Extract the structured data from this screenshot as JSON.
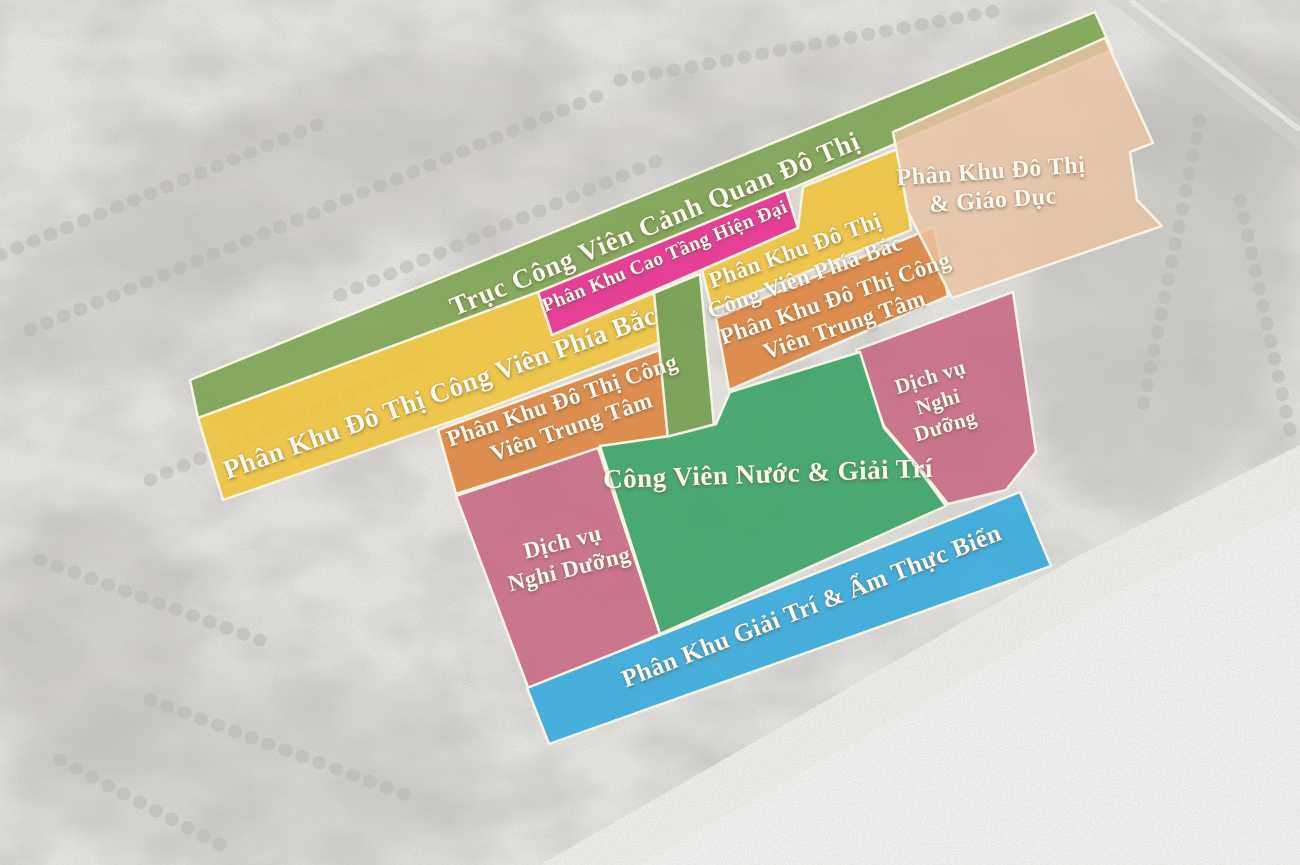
{
  "map": {
    "type": "master-plan-zoning-map",
    "outline_color": "#f8f4e4",
    "label_color": "#fcf9ee",
    "background": {
      "base_color": "#eceae7",
      "tree_color": "#b6b4b1",
      "beach_color": "#f4f3f0"
    },
    "zones": [
      {
        "id": "landscape-park-axis",
        "label": "Trục Công Viên Cảnh Quan Đô Thị",
        "color": "#7ba24f"
      },
      {
        "id": "modern-high-rise",
        "label": "Phân Khu Cao Tầng Hiện Đại",
        "color": "#e63390"
      },
      {
        "id": "urban-education",
        "label": "Phân Khu Đô Thị\n& Giáo Dục",
        "color": "#eac3a2"
      },
      {
        "id": "north-park-urban-west",
        "label": "Phân Khu Đô Thị Công Viên Phía Bắc",
        "color": "#eec33e"
      },
      {
        "id": "north-park-urban-east",
        "label": "Phân Khu Đô Thị\nCông Viên Phía Bắc",
        "color": "#eec33e"
      },
      {
        "id": "central-park-urban-west",
        "label": "Phân Khu Đô Thị Công\nViên Trung Tâm",
        "color": "#dd8540"
      },
      {
        "id": "central-park-urban-east",
        "label": "Phân Khu Đô Thị Công\nViên Trung Tâm",
        "color": "#dd8540"
      },
      {
        "id": "resort-services-east",
        "label": "Dịch vụ\nNghỉ\nDưỡng",
        "color": "#c76480"
      },
      {
        "id": "water-park-entertainment",
        "label": "Công Viên Nước & Giải Trí",
        "color": "#35a263"
      },
      {
        "id": "resort-services-west",
        "label": "Dịch vụ\nNghỉ Dưỡng",
        "color": "#c76480"
      },
      {
        "id": "beach-entertainment-cuisine",
        "label": "Phân Khu Giải Trí & Ẩm Thực Biển",
        "color": "#32a9dc"
      },
      {
        "id": "green-connector",
        "label": "",
        "color": "#6f9b4a"
      }
    ]
  }
}
